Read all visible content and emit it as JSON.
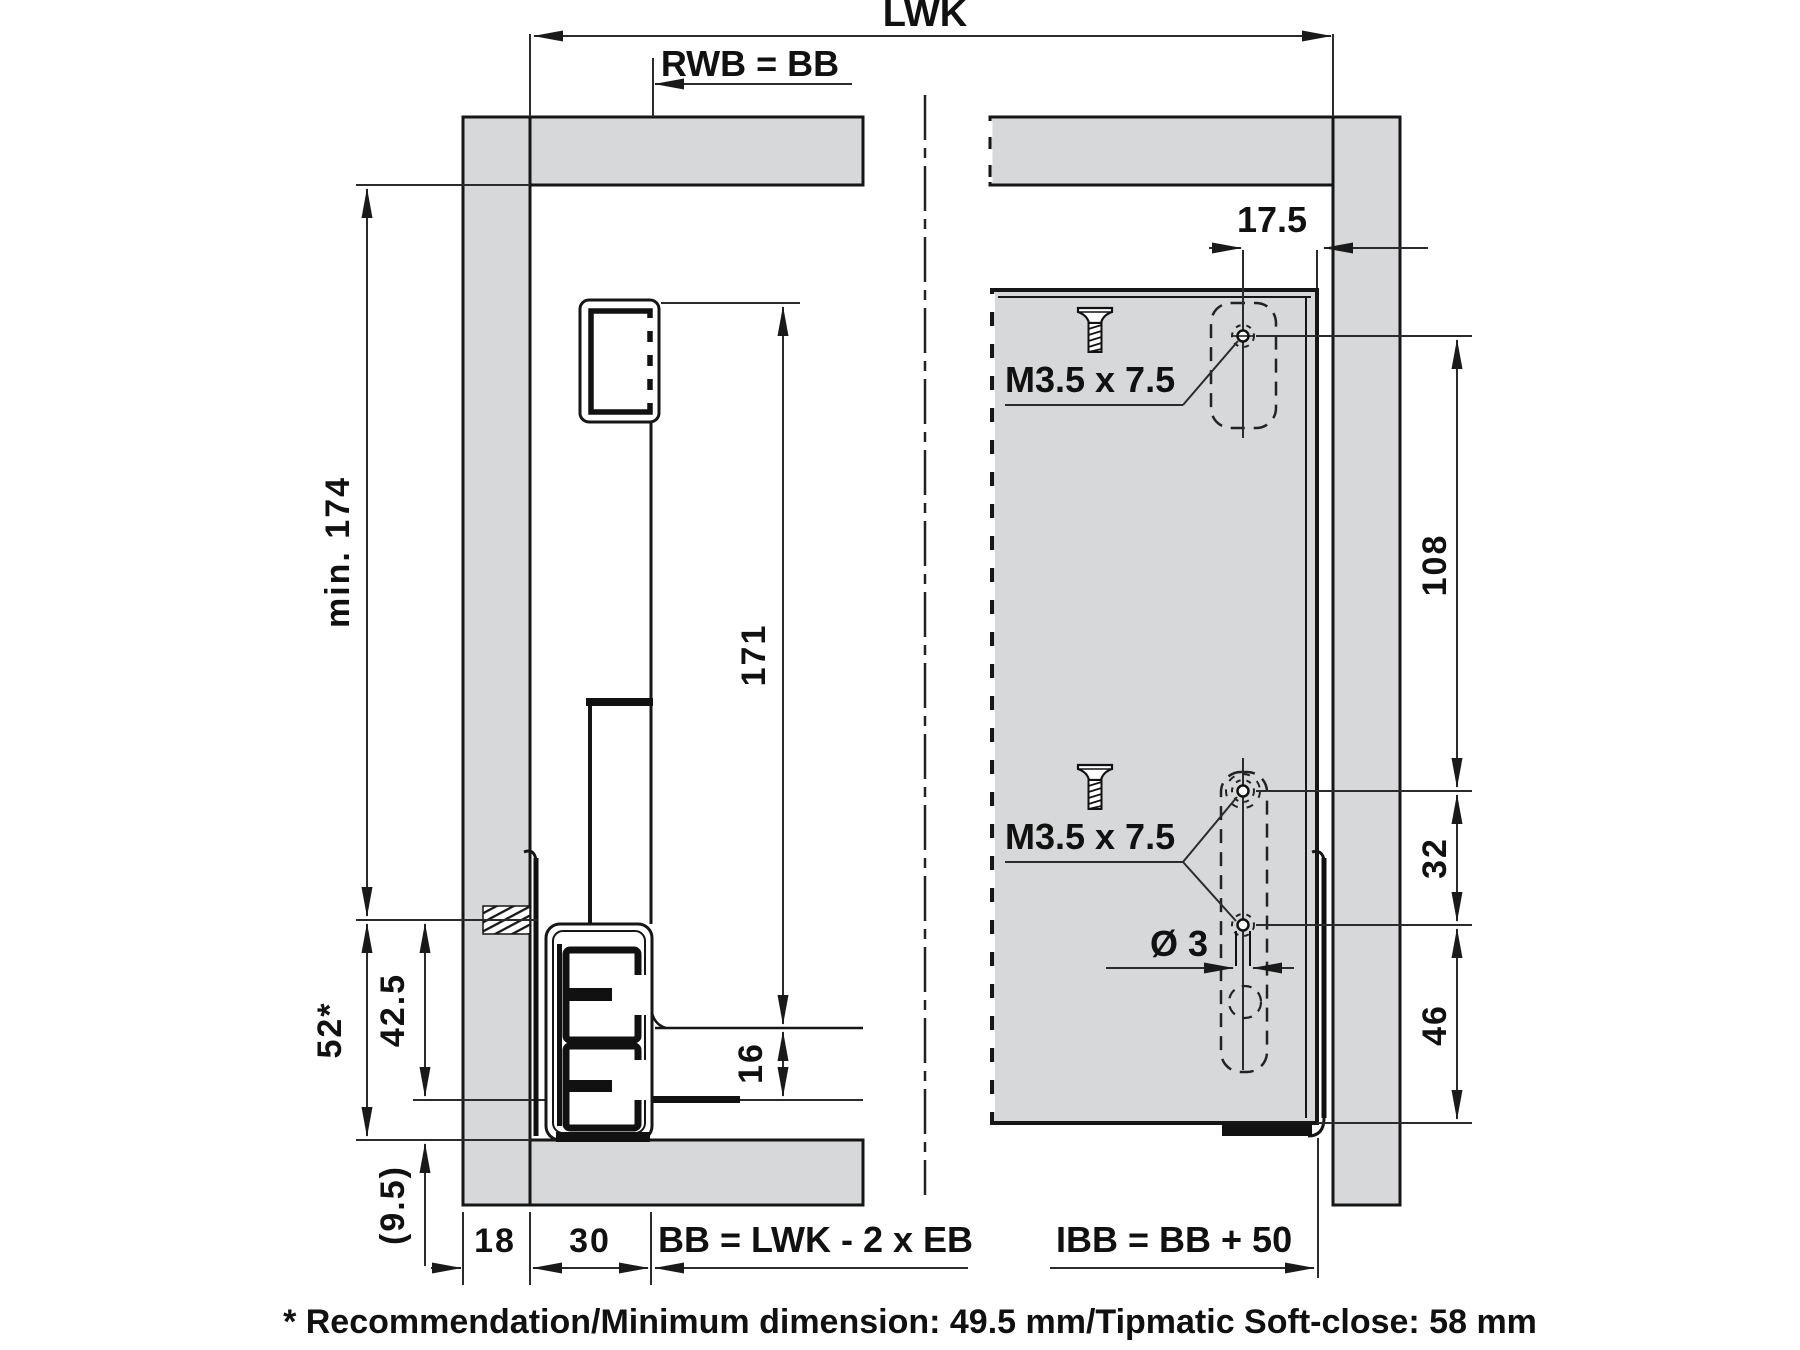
{
  "drawing": {
    "title_context": "drawer slide installation cross-section and back panel drilling pattern",
    "colors": {
      "panel_gray": "#d6d8d9",
      "line": "#161616",
      "dim_line": "#2b2b2b"
    },
    "top_dims": {
      "lwk": "LWK",
      "rwb": "RWB = BB"
    },
    "left_view": {
      "min_height": "min. 174",
      "rec_52": "52*",
      "h_42_5": "42.5",
      "h_9_5": "(9.5)",
      "h_171": "171",
      "h_16": "16",
      "w_18": "18",
      "w_30": "30",
      "bb_formula": "BB = LWK - 2  x EB"
    },
    "right_view": {
      "offset_17_5": "17.5",
      "screw_top_label": "M3.5  x 7.5",
      "screw_mid_label": "M3.5  x 7.5",
      "dia_3": "Ø 3",
      "v_108": "108",
      "v_32": "32",
      "v_46": "46",
      "ibb_formula": "IBB = BB + 50"
    },
    "footnote": "* Recommendation/Minimum dimension: 49.5 mm/Tipmatic Soft-close: 58 mm"
  }
}
